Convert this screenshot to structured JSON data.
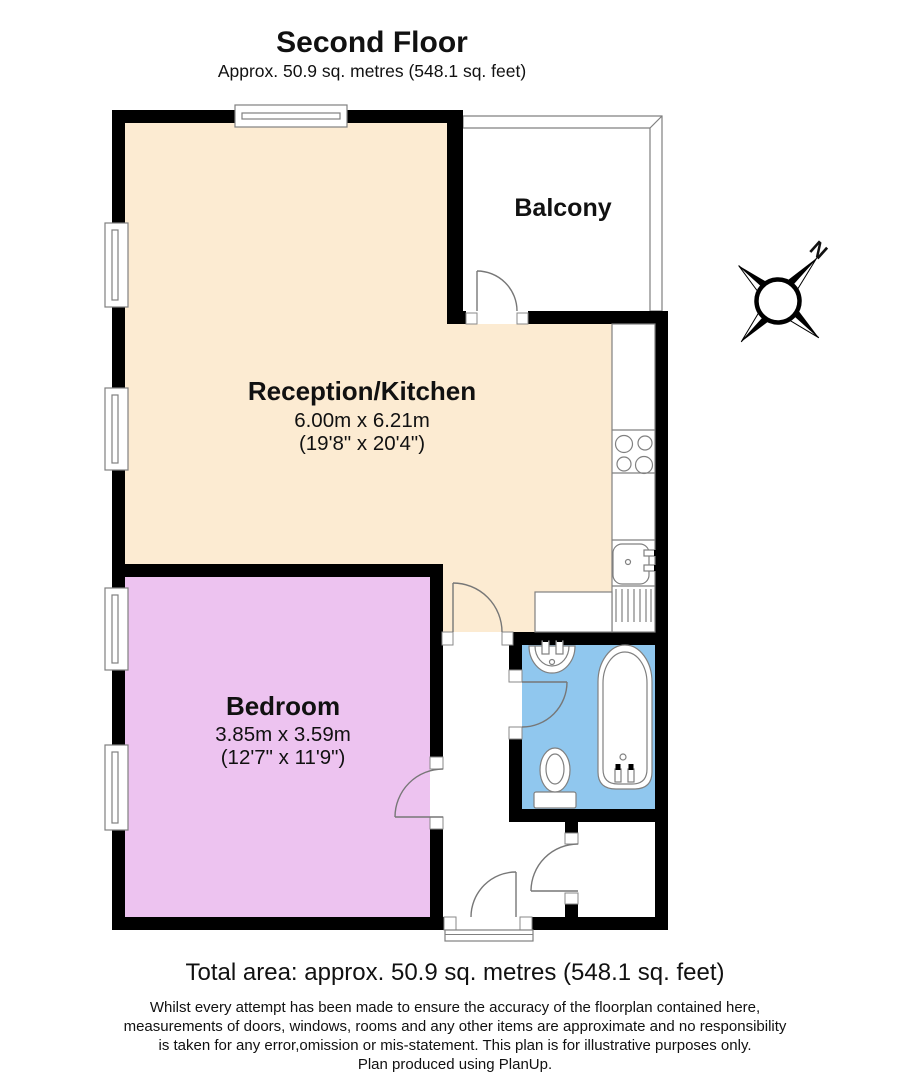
{
  "header": {
    "title": "Second Floor",
    "subtitle": "Approx. 50.9 sq. metres (548.1 sq. feet)"
  },
  "rooms": {
    "balcony": {
      "name": "Balcony",
      "floor_color": "#FFFFFF"
    },
    "reception": {
      "name": "Reception/Kitchen",
      "size_metric": "6.00m x 6.21m",
      "size_imperial": "(19'8\" x 20'4\")",
      "floor_color": "#FCEBD2"
    },
    "bedroom": {
      "name": "Bedroom",
      "size_metric": "3.85m x 3.59m",
      "size_imperial": "(12'7\" x 11'9\")",
      "floor_color": "#EDC3F0"
    },
    "bathroom": {
      "floor_color": "#90C7EE"
    }
  },
  "compass": {
    "north_label": "N"
  },
  "footer": {
    "total_area": "Total area: approx. 50.9 sq. metres (548.1 sq. feet)",
    "disclaimer_lines": [
      "Whilst every attempt has been made to ensure the accuracy of the floorplan contained here,",
      "measurements of doors, windows, rooms and any other items are approximate and no responsibility",
      "is taken for any error,omission or mis-statement. This plan is for illustrative purposes only.",
      "Plan produced using PlanUp."
    ]
  },
  "colors": {
    "wall": "#000000",
    "fixture_outline": "#808080",
    "door_swing": "#777777"
  }
}
